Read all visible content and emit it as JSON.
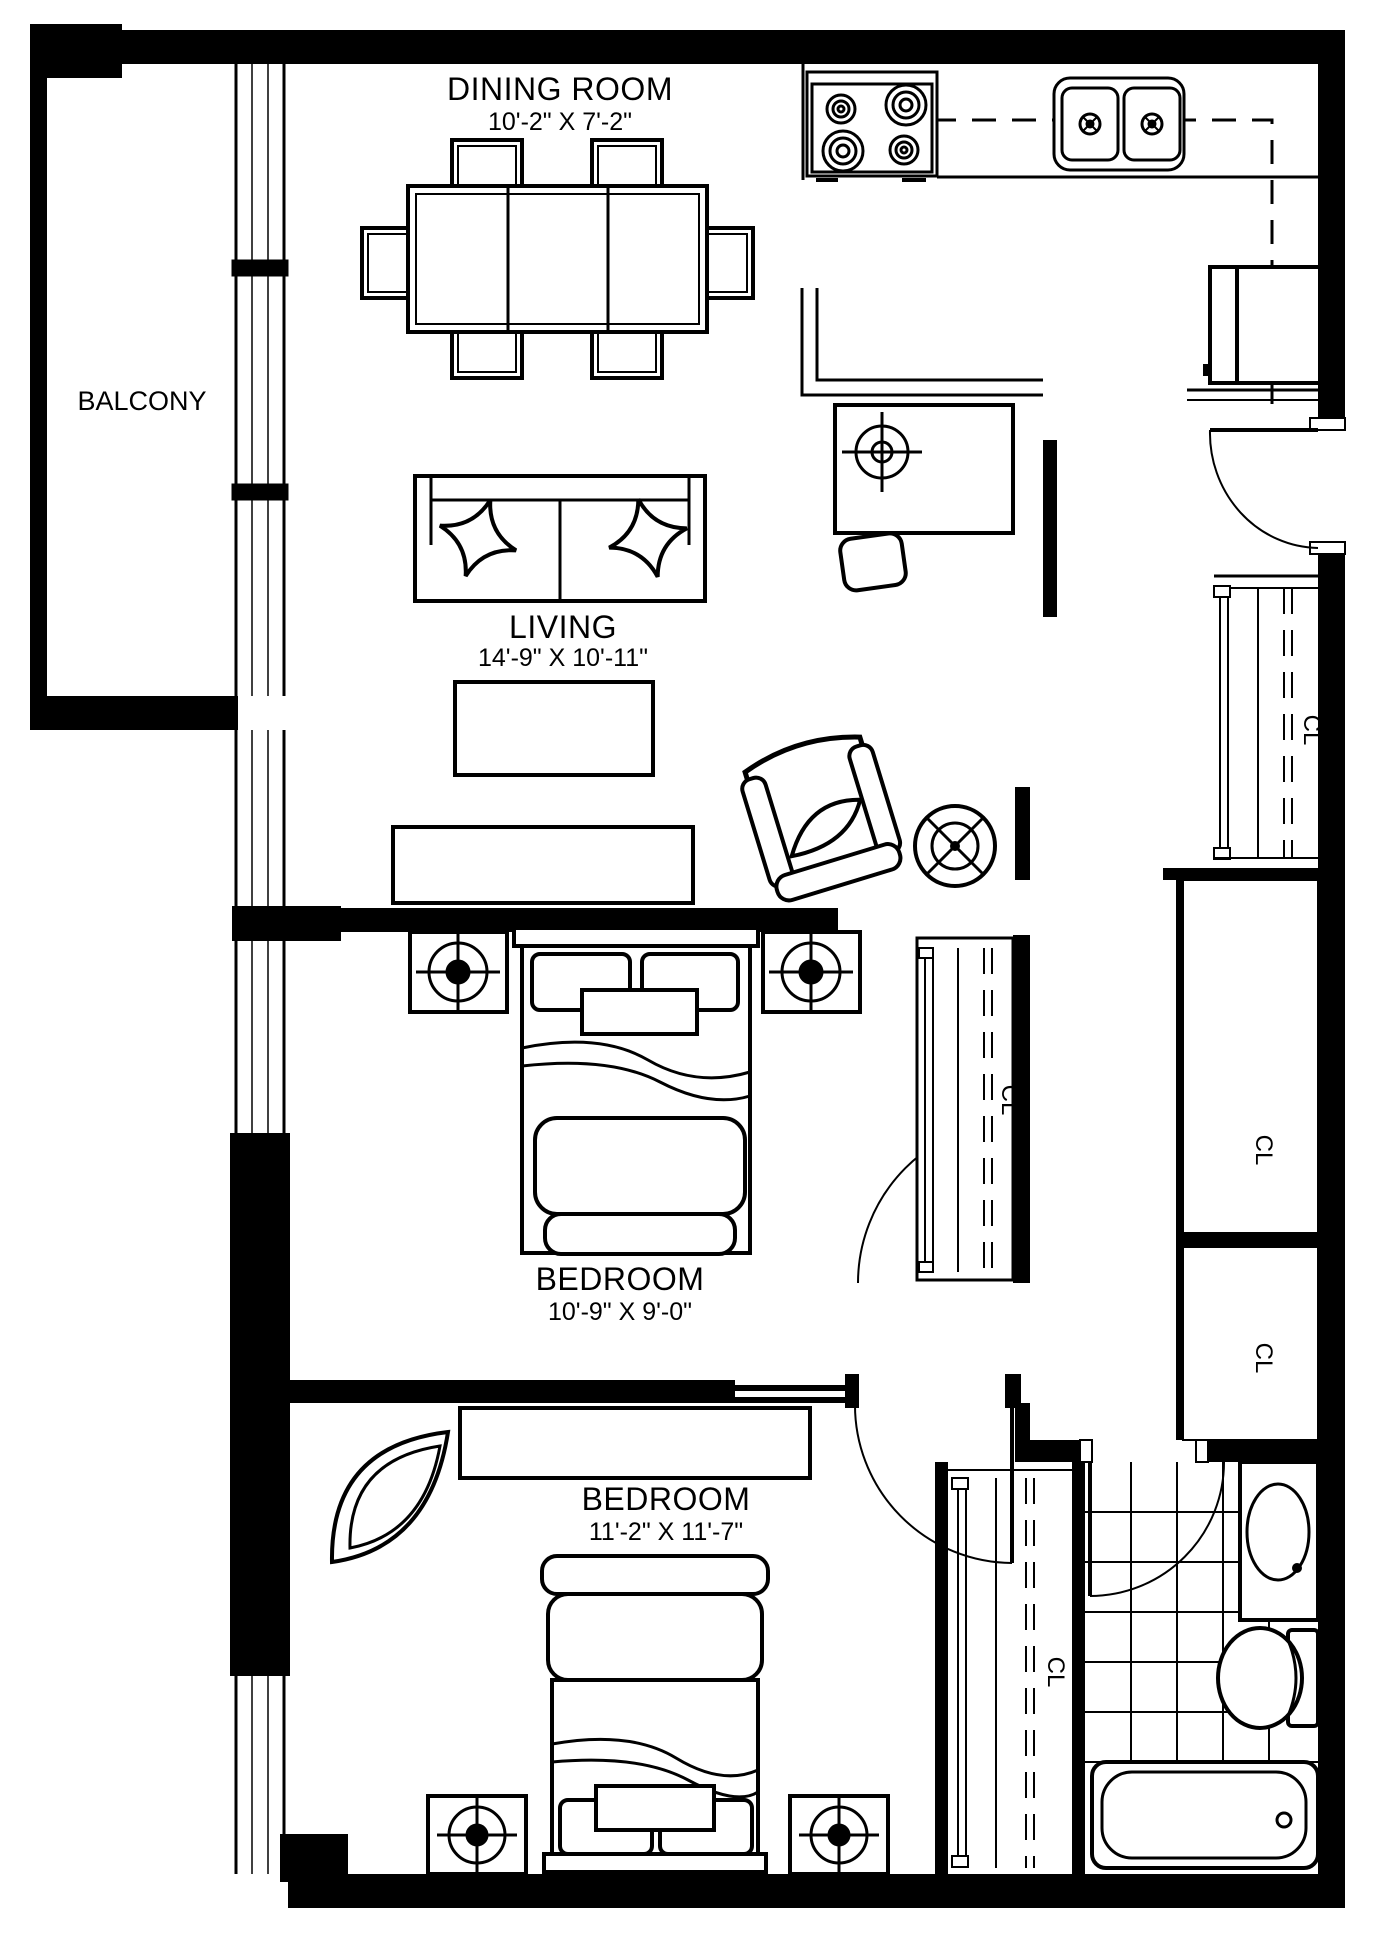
{
  "floor_plan": {
    "title": "Apartment floor plan, 2 bedroom 1 bath",
    "colors": {
      "line": "#000000",
      "background": "#ffffff"
    },
    "balcony": {
      "label": "BALCONY"
    },
    "dining_room": {
      "label": "DINING ROOM",
      "dimensions": "10'-2\" X 7'-2\""
    },
    "living_room": {
      "label": "LIVING",
      "dimensions": "14'-9\" X 10'-11\""
    },
    "bedroom_1": {
      "label": "BEDROOM",
      "dimensions": "10'-9\" X 9'-0\""
    },
    "bedroom_2": {
      "label": "BEDROOM",
      "dimensions": "11'-2\" X 11'-7\""
    },
    "closets": {
      "entry_closet": "CL",
      "hall_closet_upper": "CL",
      "hall_closet_lower": "CL",
      "bedroom1_closet": "CL",
      "bedroom2_closet": "CL"
    }
  }
}
